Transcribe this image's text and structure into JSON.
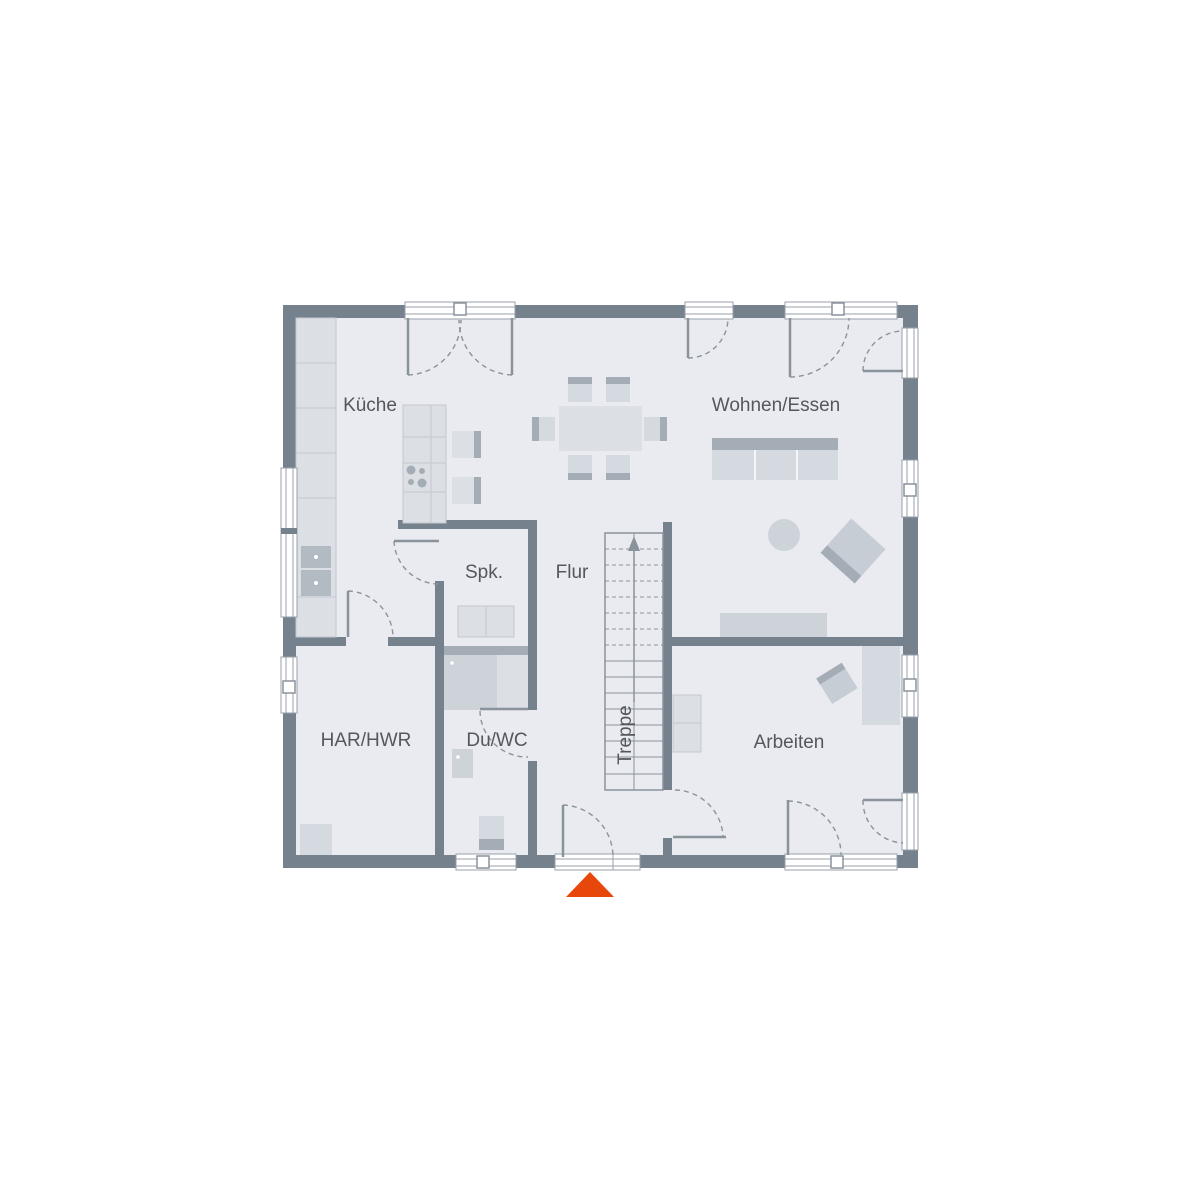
{
  "labels": {
    "kueche": "Küche",
    "wohnen_essen": "Wohnen/Essen",
    "spk": "Spk.",
    "flur": "Flur",
    "treppe": "Treppe",
    "har_hwr": "HAR/HWR",
    "du_wc": "Du/WC",
    "arbeiten": "Arbeiten"
  },
  "colors": {
    "wall": "#76818E",
    "floor": "#E9EBF0",
    "background": "#FFFFFF",
    "furniture_light": "#DCE0E5",
    "furniture_seat": "#D5DAE0",
    "furniture_mid": "#CDD3D9",
    "furniture_dark": "#A4ADB6",
    "line": "#8A929C",
    "window_frame": "#98A1AA",
    "cell_border": "#C3C9D0",
    "sink": "#B2BAC2",
    "text": "#54575B",
    "entrance_arrow": "#E8470C"
  }
}
